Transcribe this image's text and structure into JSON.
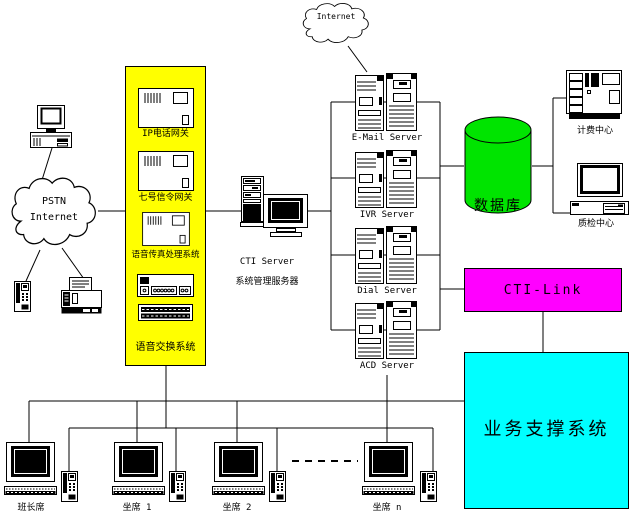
{
  "diagram": {
    "internet_cloud_label": "Internet",
    "pstn_cloud": {
      "line1": "PSTN",
      "line2": "Internet"
    },
    "voice_switch_panel": {
      "gateways": [
        "IP电话网关",
        "七号信令网关",
        "语音传真处理系统"
      ],
      "label": "语音交换系统"
    },
    "cti_server": {
      "name": "CTI Server",
      "subtitle": "系统管理服务器"
    },
    "servers": [
      "E-Mail Server",
      "IVR Server",
      "Dial Server",
      "ACD Server"
    ],
    "database_label": "数据库",
    "billing_center_label": "计费中心",
    "qa_center_label": "质检中心",
    "cti_link_label": "CTI-Link",
    "business_support_label": "业务支撑系统",
    "seats": [
      "班长席",
      "坐席 1",
      "坐席 2",
      "坐席 n"
    ]
  },
  "colors": {
    "panel_yellow": "#FFFF00",
    "database_green": "#00E400",
    "cti_link_magenta": "#FF00FF",
    "business_cyan": "#00FFFF",
    "line_black": "#000000"
  }
}
